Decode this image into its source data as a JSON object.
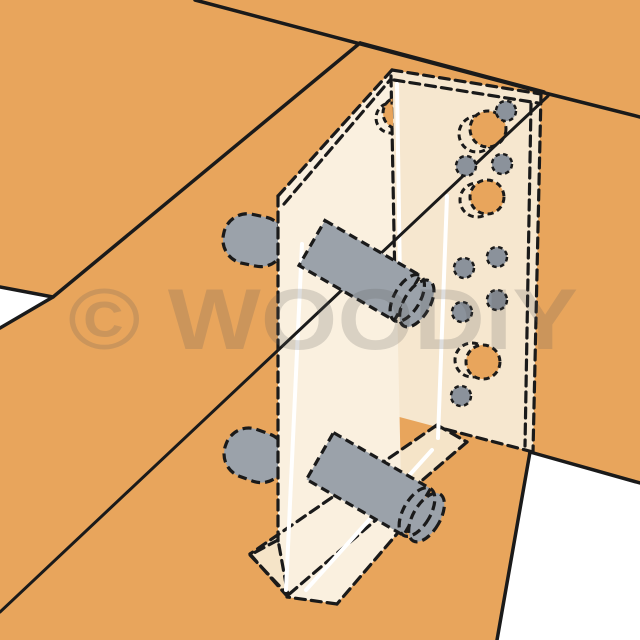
{
  "illustration": {
    "description_label": "angle-bracket-joist-connector-illustration",
    "watermark": {
      "text": "© WOODIY",
      "opacity": "0.20"
    },
    "colors": {
      "background": "#FFFFFF",
      "wood": "#E8A55C",
      "outline": "#1A1A1A",
      "bracket_web": "#FAF0DF",
      "bracket_plate": "#F6E7CF",
      "bracket_flange": "#F5E4C8",
      "dowel_gray": "#9BA2AA",
      "dot_gray": "#8B929B",
      "highlight_white": "#FFFFFF",
      "watermark_gray": "#5A5A5A"
    }
  }
}
